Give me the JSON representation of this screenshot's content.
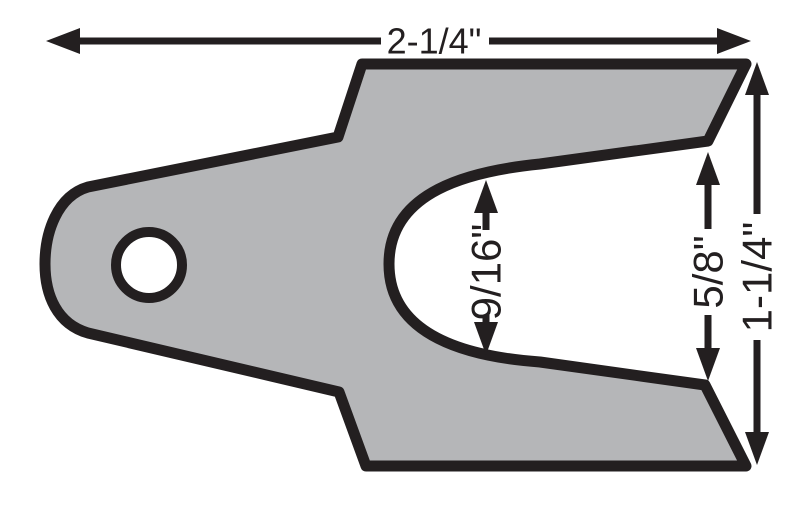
{
  "colors": {
    "background": "#ffffff",
    "part_fill": "#b5b6b8",
    "line_black": "#231f20",
    "hole_fill": "#ffffff"
  },
  "part": {
    "description": "slotted shim plate with mounting hole and U-slot opening to the right"
  },
  "dimensions": {
    "overall_width": {
      "label": "2-1/4\""
    },
    "slot_width": {
      "label": "9/16\""
    },
    "slot_opening": {
      "label": "5/8\""
    },
    "overall_height": {
      "label": "1-1/4\""
    }
  }
}
